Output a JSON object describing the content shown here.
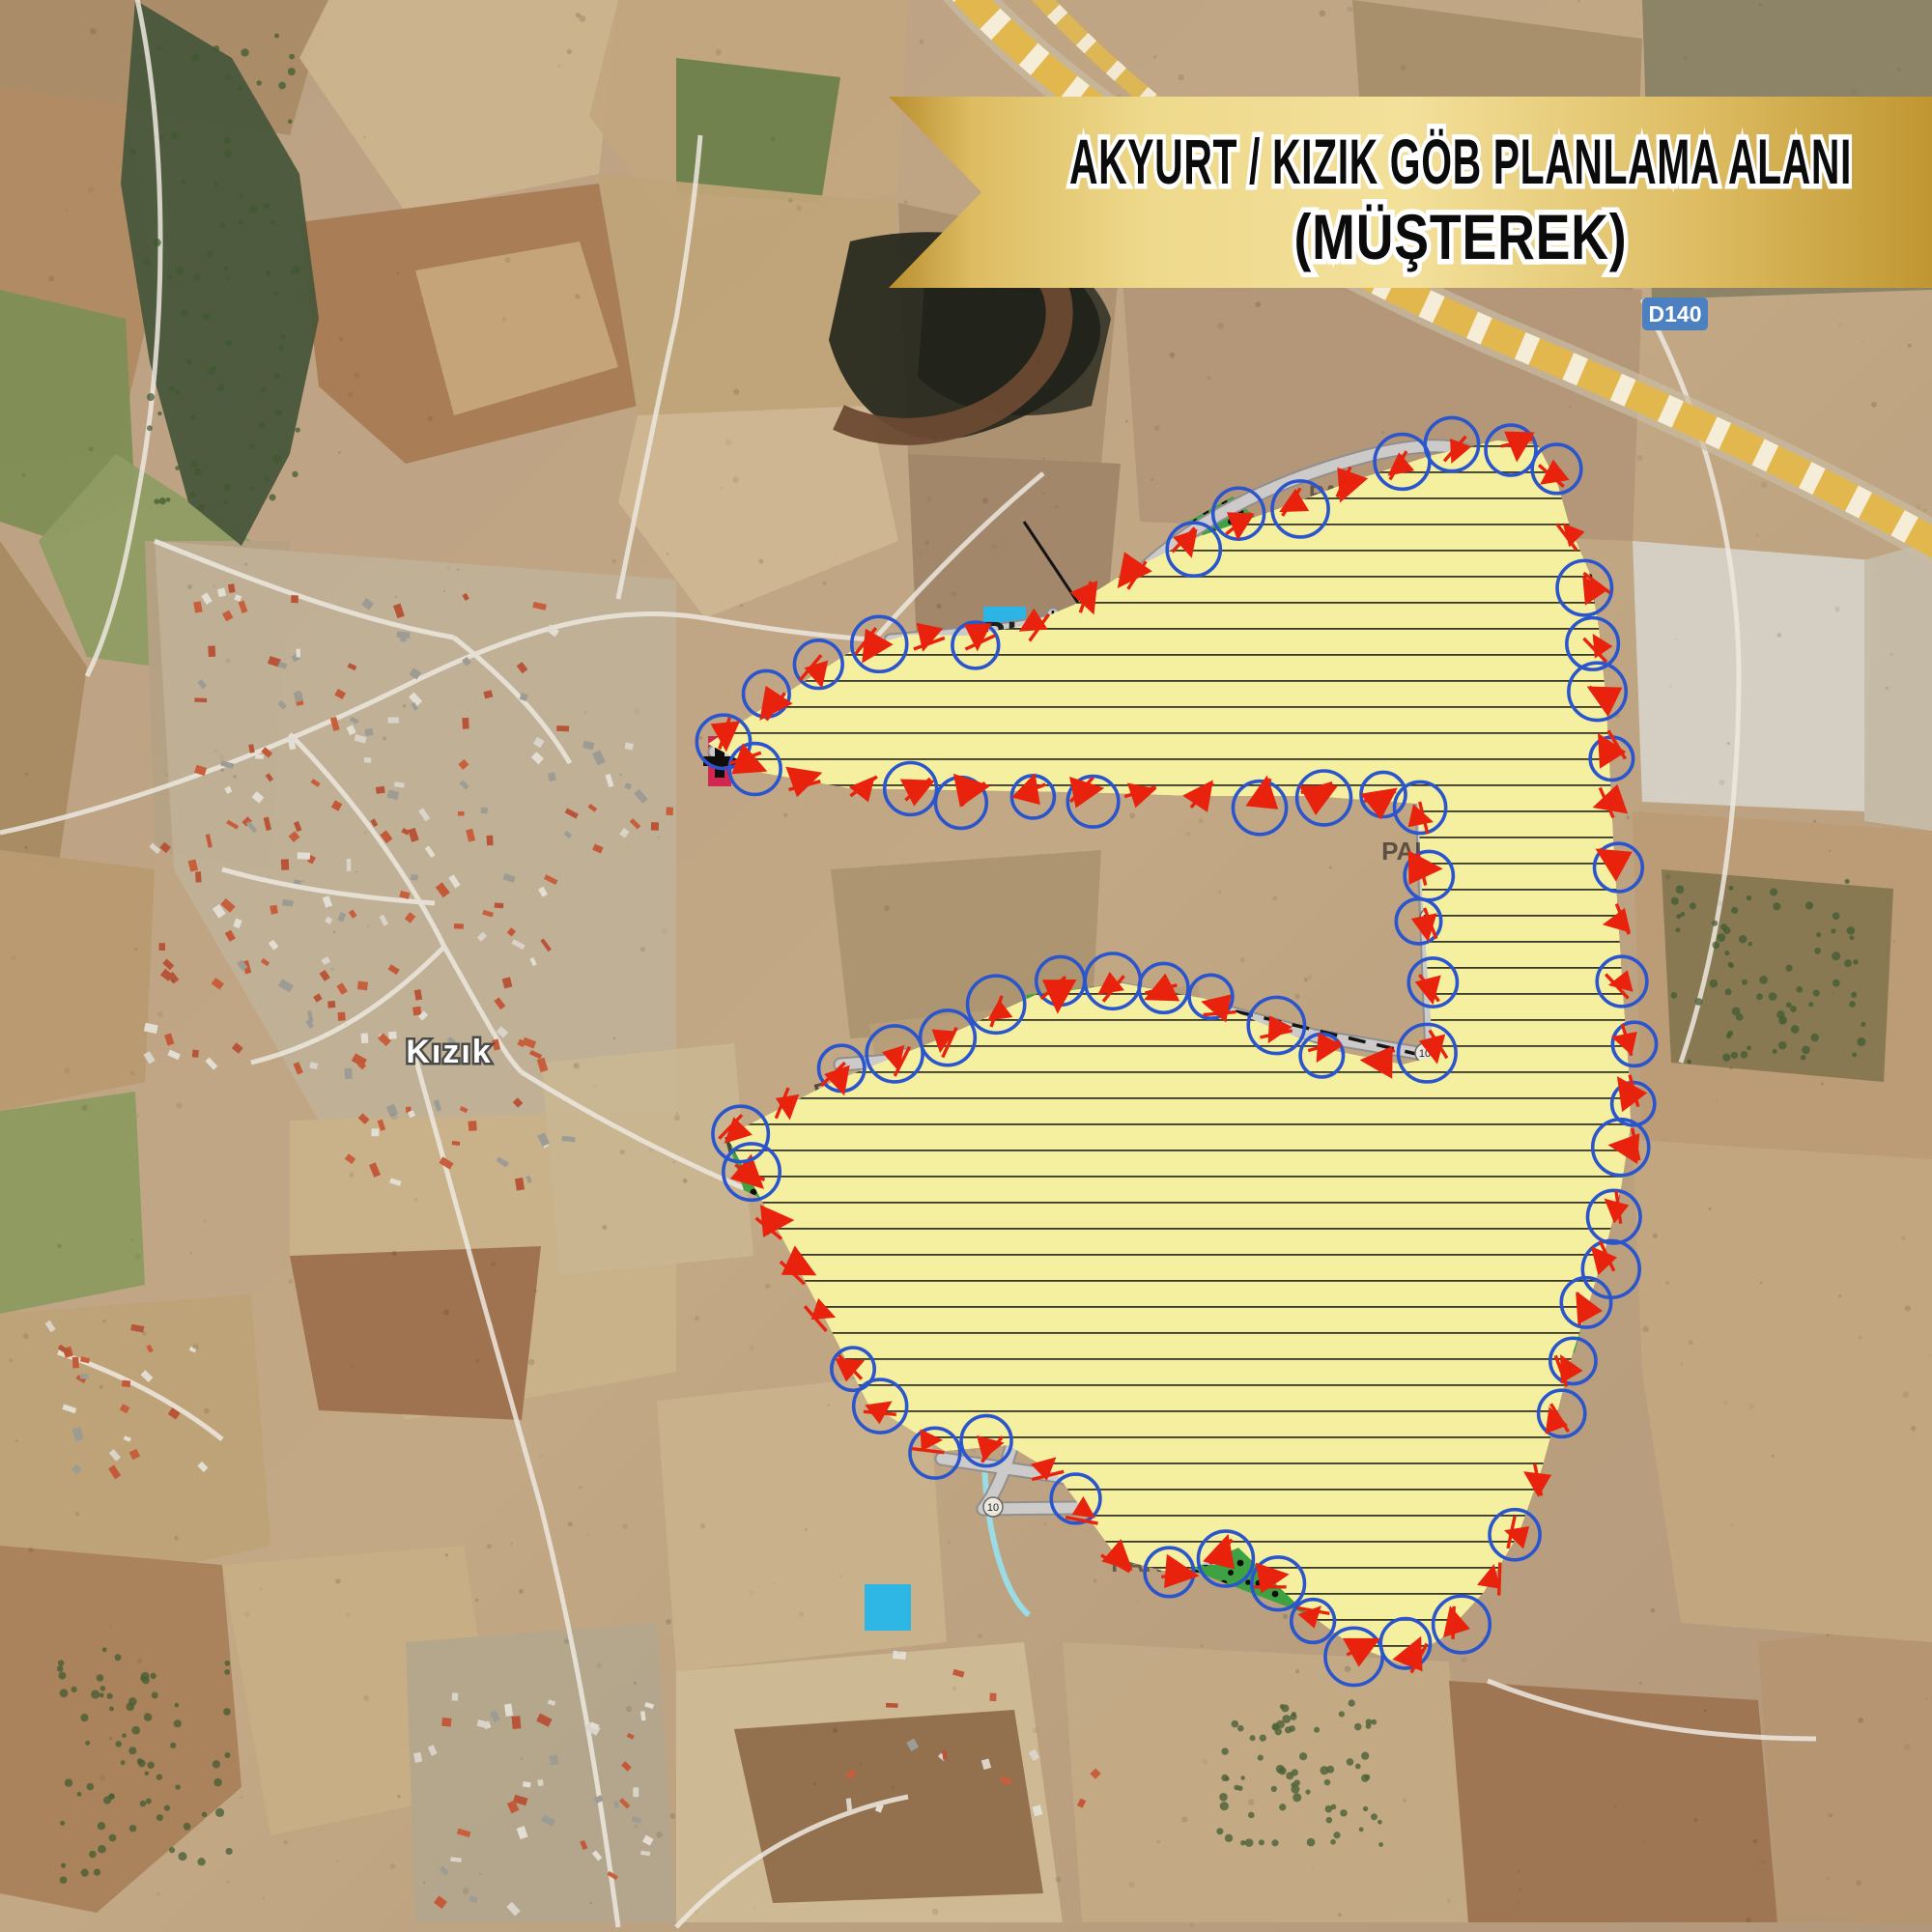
{
  "banner": {
    "line1": "AKYURT / KIZIK GÖB PLANLAMA ALANI",
    "line2": "(MÜŞTEREK)"
  },
  "road_badge": {
    "label": "D140"
  },
  "place": {
    "village": "Kızık"
  },
  "zone_labels": {
    "park": "PARK",
    "ta": "TA",
    "bha": "BHA",
    "ia": "İA",
    "ti": "Tİ",
    "oa": "ÖA",
    "oa21": "ÖA-2.1",
    "oa21_spaced": "ÖA 2.1",
    "road_width": "10"
  },
  "colors": {
    "residential_yellow": "#F5EFA0",
    "park_light_green": "#8CC878",
    "park_dark_green": "#3AA340",
    "religious_blue": "#2E9EE7",
    "facility_cyan": "#29B7E9",
    "facility_light_blue": "#BCE0F6",
    "commercial_red": "#D2234E",
    "technical_gray": "#C8C8C6",
    "boundary_red": "#E8220C",
    "boundary_circle_blue": "#2B55CC",
    "banner_gold": "#EED98C",
    "highway_yellow": "#E2B84E",
    "road_badge_blue": "#4C80C0"
  }
}
